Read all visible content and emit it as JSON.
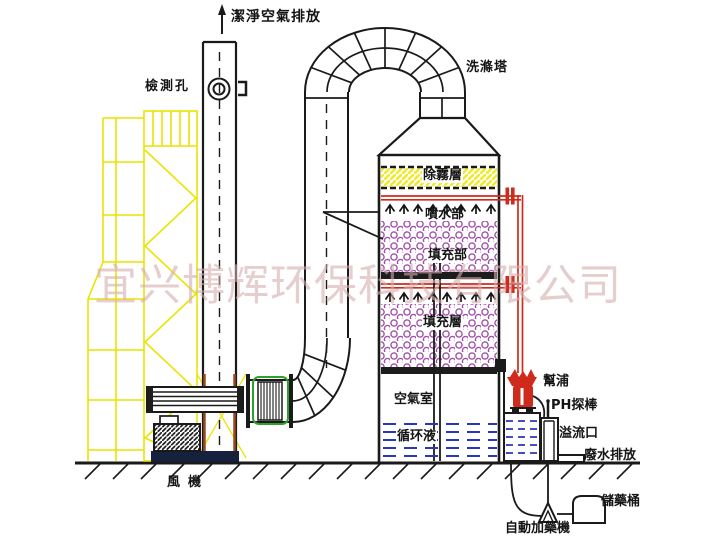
{
  "watermark": "宜兴博辉环保科技有限公司",
  "labels": {
    "clean_air": "潔淨空氣排放",
    "inspection_port": "檢測孔",
    "scrubber_tower": "洗滌塔",
    "demister": "除霧層",
    "spray_section": "噴水部",
    "packing_section_upper": "填充部",
    "packing_section_lower": "填充層",
    "air_chamber": "空氣室",
    "circulating_liquid": "循环液",
    "fan": "風機",
    "pump": "幫浦",
    "ph_probe": "PH探棒",
    "overflow_port": "溢流口",
    "wastewater_discharge": "廢水排放",
    "chemical_storage_tank": "儲藥桶",
    "auto_dosing_machine": "自動加藥機"
  },
  "colors": {
    "line": "#1a1a1a",
    "scaffold": "#e9e400",
    "pipe_red": "#cf2a1b",
    "packing": "#a050a8",
    "liquid": "#2838b8",
    "fan_green": "#2ea02e",
    "chimney_brown": "#9b4a20",
    "base_navy": "#16213e",
    "demister_yellow": "#efe92f",
    "watermark": "rgba(213,173,173,0.60)"
  }
}
